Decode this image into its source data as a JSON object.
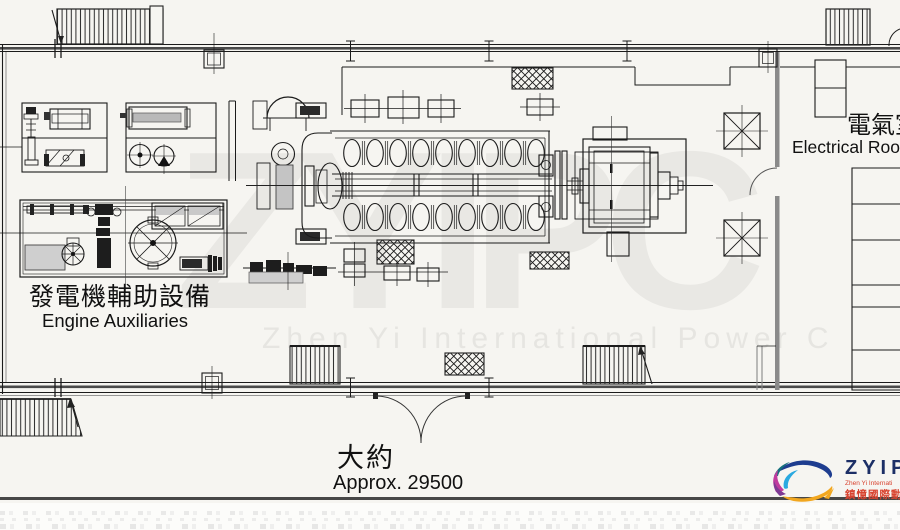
{
  "page": {
    "background": "#f6f5f1",
    "footer_rule_color": "#474747"
  },
  "labels": {
    "engine_auxiliaries": {
      "zh": "發電機輔助設備",
      "en": "Engine Auxiliaries"
    },
    "electrical_room": {
      "zh": "電氣室",
      "en": "Electrical Room"
    },
    "dimension": {
      "zh": "大約",
      "en": "Approx. 29500"
    }
  },
  "watermark": {
    "big_text": "ZYIPC",
    "line_text": "Zhen Yi International Power C",
    "color": "#e8e7e3"
  },
  "logo": {
    "acronym": "ZYIPC",
    "subtitle_en": "Zhen Yi Internati",
    "subtitle_zh": "鎮憶國際動力",
    "colors": {
      "navy": "#1e3d8f",
      "teal": "#15707e",
      "cyan": "#2aa9e0",
      "magenta": "#c13a9e",
      "purple": "#7e3a94",
      "yellow": "#f2a71f",
      "red": "#d8432f",
      "text_navy": "#1c2f66"
    }
  }
}
